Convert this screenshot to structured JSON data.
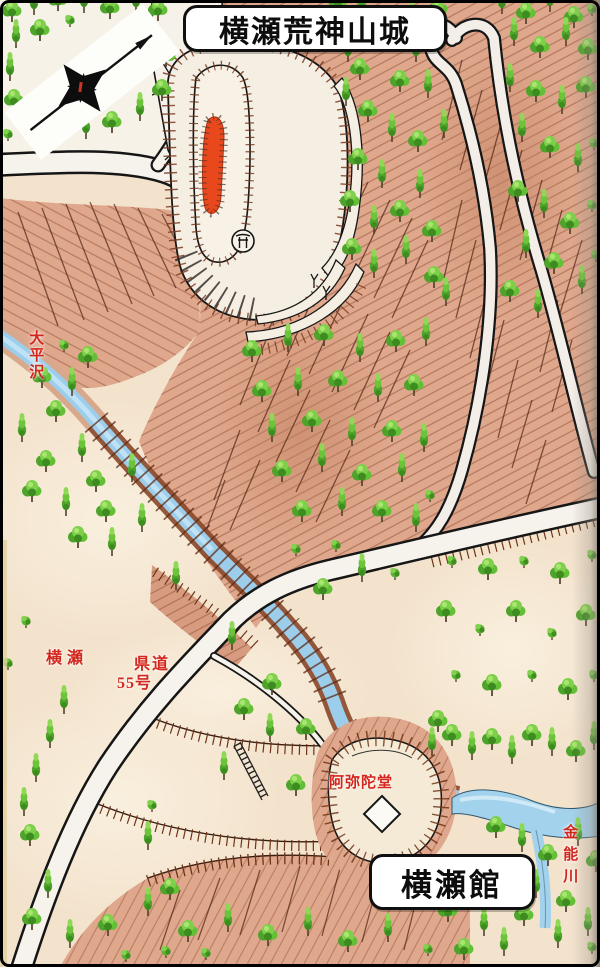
{
  "map": {
    "title": "横瀬荒神山城",
    "labels": {
      "residence": "横瀬館",
      "stream": "大平沢",
      "village": "横瀬",
      "route_l1": "県道",
      "route_l2": "55号",
      "temple": "阿弥陀堂",
      "river": "金能川"
    },
    "icons": {
      "compass": "eight-pointed-star-pointing-northeast",
      "shrine": "torii-in-circle",
      "building": "white-diamond-square",
      "keep_marker": "red-elongated-mound"
    },
    "colors": {
      "label_red": "#d3261c",
      "terrain_pink": "#dfa78c",
      "terrain_dark_bank": "#8a4a2c",
      "tree_green": "#5cb52f",
      "tree_dark_green": "#3c8c1f",
      "water_blue": "#9ccdea",
      "paper_beige": "#f3e3cd",
      "ink": "#1a1a1a"
    }
  }
}
